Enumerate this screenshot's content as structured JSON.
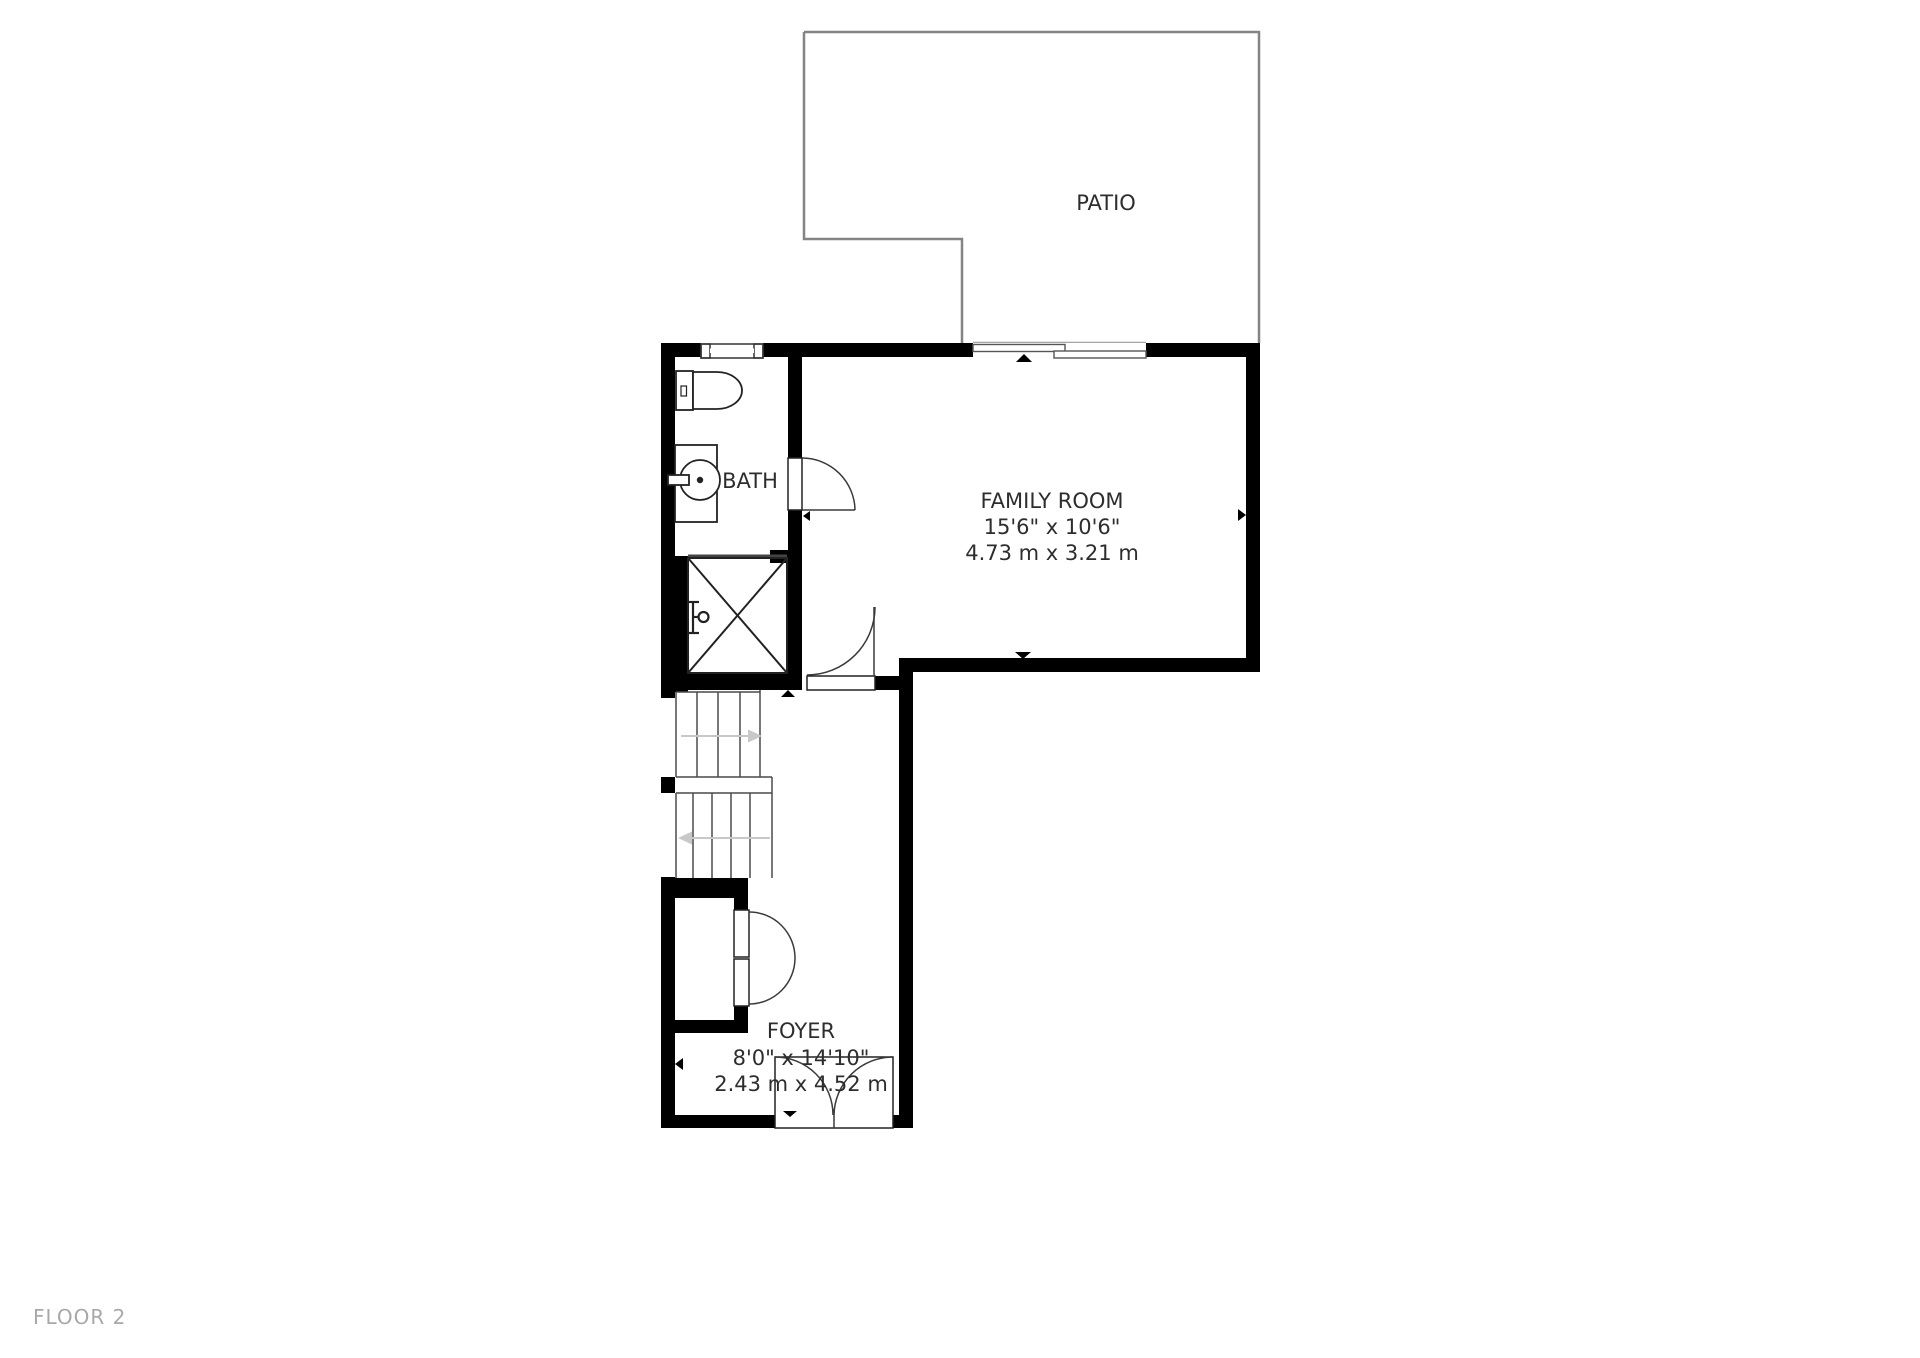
{
  "floor_label": "FLOOR 2",
  "rooms": {
    "patio": {
      "name": "PATIO"
    },
    "bath": {
      "name": "BATH"
    },
    "family_room": {
      "name": "FAMILY ROOM",
      "dim_imperial": "15'6\" x 10'6\"",
      "dim_metric": "4.73 m x 3.21 m"
    },
    "foyer": {
      "name": "FOYER",
      "dim_imperial": "8'0\" x 14'10\"",
      "dim_metric": "2.43 m x 4.52 m"
    }
  },
  "colors": {
    "background": "#ffffff",
    "wall": "#000000",
    "text": "#2d2d2d",
    "floor_label": "#a8a8a8",
    "patio_outline": "#848484",
    "window_fill": "#e4e4f4",
    "stair_arrow": "#c8c8c8"
  },
  "icons": {
    "toilet": "toilet-plan-symbol",
    "sink": "round-basin-vanity",
    "shower": "crossed-square",
    "stairs": "treads-with-direction-arrows",
    "door": "quarter-circle-swing",
    "window": "triple-pane-band",
    "sliding_door": "offset-double-panels",
    "opening_marker": "small-black-triangle"
  }
}
